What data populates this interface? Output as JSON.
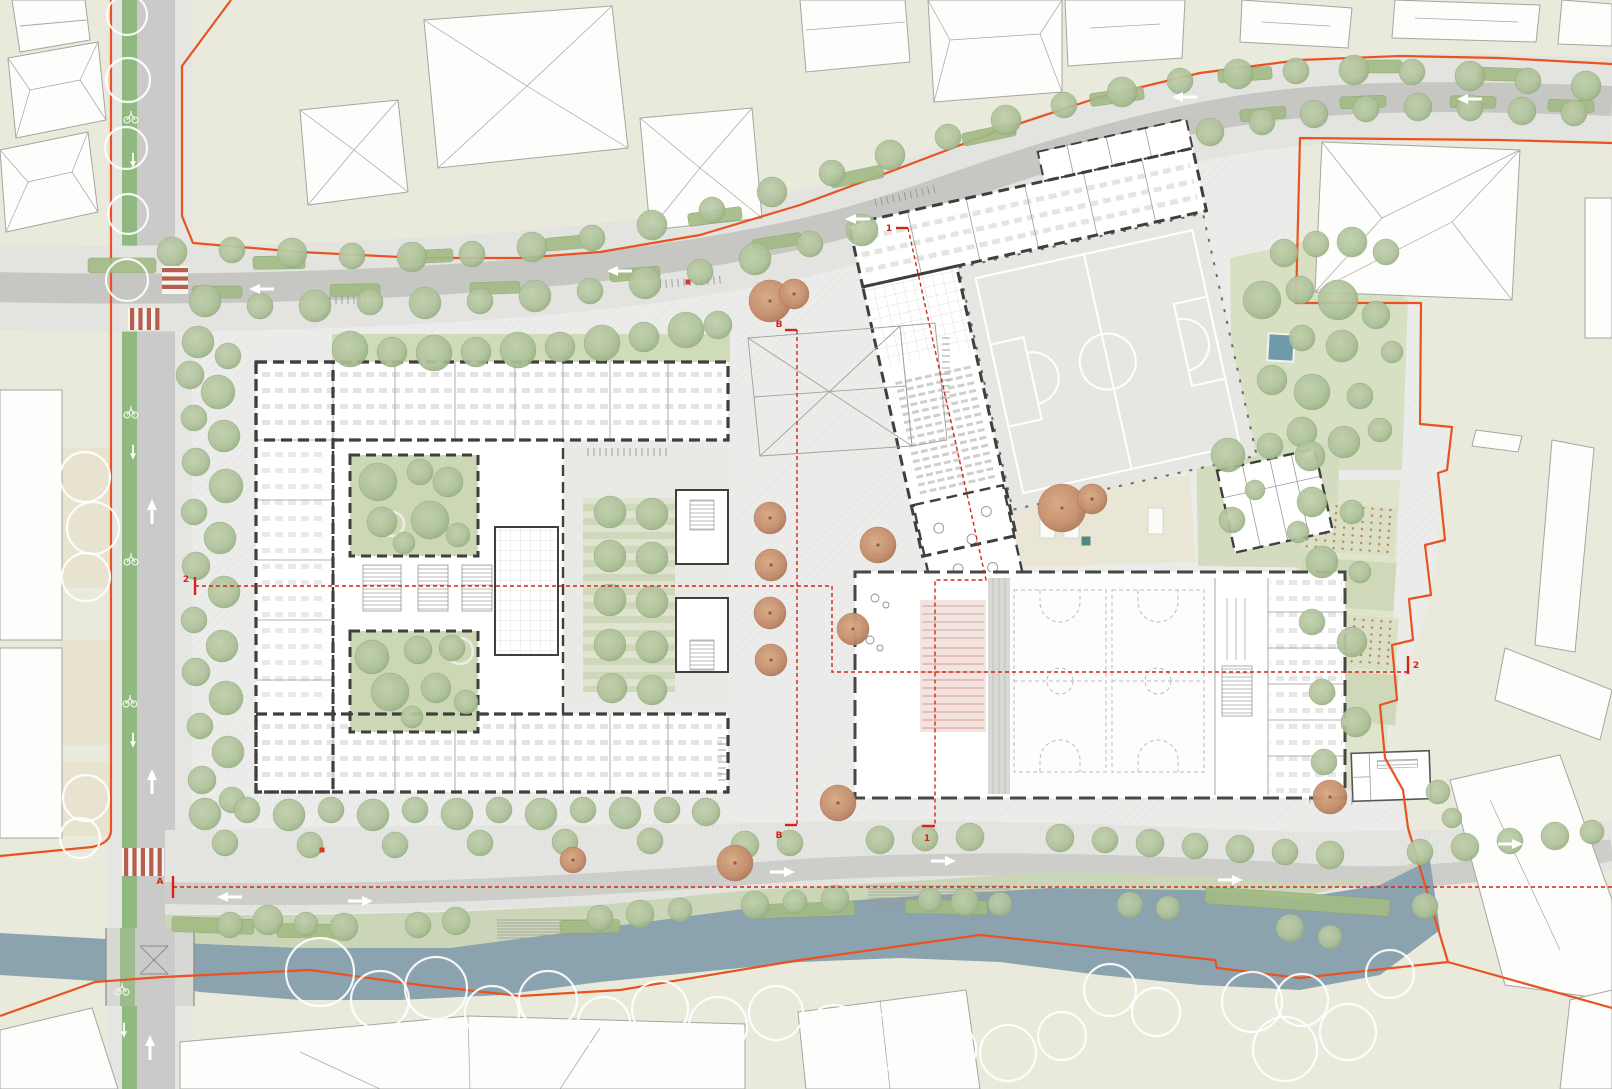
{
  "meta": {
    "drawing_type": "architectural site / ground-floor master plan",
    "content": "school campus with two courtyards, rooftop soccer pitch building, double sports hall, plaza, tree-lined streets and canal"
  },
  "colors": {
    "ground_context": "#e9eadb",
    "site_paving": "#ecedea",
    "lawn": "#cfdbb9",
    "lawn_bright": "#d8e0c4",
    "hedge": "#a3bb85",
    "tree_green": "#aec29b",
    "tree_orange": "#c68f6d",
    "water": "#8ba3ae",
    "road": "#cacac8",
    "sidewalk": "#e5e5e1",
    "bike_lane": "#8fb97e",
    "crosswalk_red": "#b5604e",
    "boundary_orange": "#e8531f",
    "section_red": "#d42518",
    "wall_dark": "#3f3f3e",
    "pitch": "#e6e6e2",
    "tribune_red": "#cf9c92",
    "pool_blue": "#6f9aaa"
  },
  "sections": [
    {
      "id": "A",
      "path": "M173 887 L1612 887",
      "ticks": [
        "M173 876 L173 898"
      ],
      "labels": [
        {
          "t": "A",
          "x": 160,
          "y": 884
        }
      ]
    },
    {
      "id": "B",
      "path": "M797 330 L797 825",
      "ticks": [
        "M785 330 L797 330",
        "M785 825 L797 825"
      ],
      "labels": [
        {
          "t": "B",
          "x": 779,
          "y": 327
        },
        {
          "t": "B",
          "x": 779,
          "y": 838
        }
      ]
    },
    {
      "id": "1",
      "path": "M908 228 L986 580 L935 580 L935 826",
      "ticks": [
        "M896 228 L908 228",
        "M922 826 L935 826"
      ],
      "labels": [
        {
          "t": "1",
          "x": 889,
          "y": 231
        },
        {
          "t": "1",
          "x": 927,
          "y": 841
        }
      ]
    },
    {
      "id": "2",
      "path": "M195 586 L832 586 L832 672 L1408 672",
      "ticks": [
        "M195 577 L195 595",
        "M1408 656 L1408 674"
      ],
      "labels": [
        {
          "t": "2",
          "x": 186,
          "y": 582
        },
        {
          "t": "2",
          "x": 1416,
          "y": 668
        }
      ]
    }
  ],
  "trees": {
    "green": [
      [
        172,
        252,
        15
      ],
      [
        232,
        250,
        13
      ],
      [
        292,
        253,
        15
      ],
      [
        352,
        256,
        13
      ],
      [
        412,
        257,
        15
      ],
      [
        472,
        254,
        13
      ],
      [
        532,
        247,
        15
      ],
      [
        592,
        238,
        13
      ],
      [
        652,
        225,
        15
      ],
      [
        712,
        210,
        13
      ],
      [
        772,
        192,
        15
      ],
      [
        832,
        173,
        13
      ],
      [
        890,
        155,
        15
      ],
      [
        948,
        137,
        13
      ],
      [
        1006,
        120,
        15
      ],
      [
        1064,
        105,
        13
      ],
      [
        1122,
        92,
        15
      ],
      [
        1180,
        81,
        13
      ],
      [
        1238,
        74,
        15
      ],
      [
        1296,
        71,
        13
      ],
      [
        1354,
        70,
        15
      ],
      [
        1412,
        72,
        13
      ],
      [
        1470,
        76,
        15
      ],
      [
        1528,
        81,
        13
      ],
      [
        1586,
        86,
        15
      ],
      [
        205,
        301,
        16
      ],
      [
        260,
        306,
        13
      ],
      [
        315,
        306,
        16
      ],
      [
        370,
        302,
        13
      ],
      [
        425,
        303,
        16
      ],
      [
        480,
        301,
        13
      ],
      [
        535,
        296,
        16
      ],
      [
        590,
        291,
        13
      ],
      [
        645,
        283,
        16
      ],
      [
        700,
        272,
        13
      ],
      [
        755,
        259,
        16
      ],
      [
        810,
        244,
        13
      ],
      [
        862,
        230,
        16
      ],
      [
        1210,
        132,
        14
      ],
      [
        1262,
        122,
        13
      ],
      [
        1314,
        114,
        14
      ],
      [
        1366,
        109,
        13
      ],
      [
        1418,
        107,
        14
      ],
      [
        1470,
        108,
        13
      ],
      [
        1522,
        111,
        14
      ],
      [
        1574,
        113,
        13
      ],
      [
        350,
        349,
        18
      ],
      [
        392,
        352,
        15
      ],
      [
        434,
        353,
        18
      ],
      [
        476,
        352,
        15
      ],
      [
        518,
        350,
        18
      ],
      [
        560,
        347,
        15
      ],
      [
        602,
        343,
        18
      ],
      [
        644,
        337,
        15
      ],
      [
        686,
        330,
        18
      ],
      [
        718,
        325,
        14
      ],
      [
        198,
        342,
        16
      ],
      [
        228,
        356,
        13
      ],
      [
        190,
        375,
        14
      ],
      [
        218,
        392,
        17
      ],
      [
        194,
        418,
        13
      ],
      [
        224,
        436,
        16
      ],
      [
        196,
        462,
        14
      ],
      [
        226,
        486,
        17
      ],
      [
        194,
        512,
        13
      ],
      [
        220,
        538,
        16
      ],
      [
        196,
        566,
        14
      ],
      [
        224,
        592,
        16
      ],
      [
        194,
        620,
        13
      ],
      [
        222,
        646,
        16
      ],
      [
        196,
        672,
        14
      ],
      [
        226,
        698,
        17
      ],
      [
        200,
        726,
        13
      ],
      [
        228,
        752,
        16
      ],
      [
        202,
        780,
        14
      ],
      [
        232,
        800,
        13
      ],
      [
        205,
        814,
        16
      ],
      [
        247,
        810,
        13
      ],
      [
        289,
        815,
        16
      ],
      [
        331,
        810,
        13
      ],
      [
        373,
        815,
        16
      ],
      [
        415,
        810,
        13
      ],
      [
        457,
        814,
        16
      ],
      [
        499,
        810,
        13
      ],
      [
        541,
        814,
        16
      ],
      [
        583,
        810,
        13
      ],
      [
        625,
        813,
        16
      ],
      [
        667,
        810,
        13
      ],
      [
        706,
        812,
        14
      ],
      [
        225,
        843,
        13
      ],
      [
        310,
        845,
        13
      ],
      [
        395,
        845,
        13
      ],
      [
        480,
        843,
        13
      ],
      [
        565,
        842,
        13
      ],
      [
        650,
        841,
        13
      ],
      [
        745,
        845,
        14
      ],
      [
        790,
        843,
        13
      ],
      [
        880,
        840,
        14
      ],
      [
        925,
        838,
        13
      ],
      [
        970,
        837,
        14
      ],
      [
        1060,
        838,
        14
      ],
      [
        1105,
        840,
        13
      ],
      [
        1150,
        843,
        14
      ],
      [
        1195,
        846,
        13
      ],
      [
        1240,
        849,
        14
      ],
      [
        1285,
        852,
        13
      ],
      [
        1330,
        855,
        14
      ],
      [
        1420,
        852,
        13
      ],
      [
        1465,
        847,
        14
      ],
      [
        1510,
        841,
        13
      ],
      [
        1555,
        836,
        14
      ],
      [
        1592,
        832,
        12
      ],
      [
        230,
        925,
        13
      ],
      [
        268,
        920,
        15
      ],
      [
        306,
        924,
        12
      ],
      [
        344,
        927,
        14
      ],
      [
        418,
        925,
        13
      ],
      [
        456,
        921,
        14
      ],
      [
        600,
        918,
        13
      ],
      [
        640,
        914,
        14
      ],
      [
        680,
        910,
        12
      ],
      [
        755,
        905,
        14
      ],
      [
        795,
        902,
        12
      ],
      [
        835,
        899,
        14
      ],
      [
        930,
        900,
        12
      ],
      [
        965,
        902,
        14
      ],
      [
        1000,
        904,
        12
      ],
      [
        1130,
        905,
        13
      ],
      [
        1168,
        908,
        12
      ],
      [
        1290,
        928,
        14
      ],
      [
        1330,
        937,
        12
      ],
      [
        1425,
        906,
        13
      ],
      [
        610,
        512,
        16
      ],
      [
        652,
        514,
        16
      ],
      [
        610,
        556,
        16
      ],
      [
        652,
        558,
        16
      ],
      [
        610,
        600,
        16
      ],
      [
        652,
        602,
        16
      ],
      [
        610,
        645,
        16
      ],
      [
        652,
        647,
        16
      ],
      [
        612,
        688,
        15
      ],
      [
        652,
        690,
        15
      ],
      [
        378,
        482,
        19
      ],
      [
        420,
        472,
        13
      ],
      [
        448,
        482,
        15
      ],
      [
        382,
        522,
        15
      ],
      [
        430,
        520,
        19
      ],
      [
        458,
        535,
        12
      ],
      [
        404,
        543,
        11
      ],
      [
        372,
        657,
        17
      ],
      [
        418,
        650,
        14
      ],
      [
        452,
        648,
        13
      ],
      [
        390,
        692,
        19
      ],
      [
        436,
        688,
        15
      ],
      [
        466,
        702,
        12
      ],
      [
        412,
        717,
        11
      ],
      [
        1262,
        300,
        19
      ],
      [
        1300,
        290,
        14
      ],
      [
        1338,
        300,
        20
      ],
      [
        1376,
        315,
        14
      ],
      [
        1302,
        338,
        13
      ],
      [
        1342,
        346,
        16
      ],
      [
        1272,
        380,
        15
      ],
      [
        1312,
        392,
        18
      ],
      [
        1360,
        396,
        13
      ],
      [
        1302,
        432,
        15
      ],
      [
        1344,
        442,
        16
      ],
      [
        1380,
        430,
        12
      ],
      [
        1392,
        352,
        11
      ],
      [
        1386,
        252,
        13
      ],
      [
        1352,
        242,
        15
      ],
      [
        1316,
        244,
        13
      ],
      [
        1284,
        253,
        14
      ],
      [
        1312,
        502,
        15
      ],
      [
        1352,
        512,
        12
      ],
      [
        1322,
        562,
        16
      ],
      [
        1360,
        572,
        11
      ],
      [
        1312,
        622,
        13
      ],
      [
        1352,
        642,
        15
      ],
      [
        1322,
        692,
        13
      ],
      [
        1356,
        722,
        15
      ],
      [
        1324,
        762,
        13
      ],
      [
        1228,
        455,
        17
      ],
      [
        1270,
        446,
        13
      ],
      [
        1310,
        456,
        15
      ],
      [
        1232,
        520,
        13
      ],
      [
        1298,
        532,
        11
      ],
      [
        1255,
        490,
        10
      ],
      [
        1438,
        792,
        12
      ],
      [
        1452,
        818,
        10
      ]
    ],
    "orange": [
      [
        770,
        301,
        21
      ],
      [
        794,
        294,
        15
      ],
      [
        770,
        518,
        16
      ],
      [
        771,
        565,
        16
      ],
      [
        770,
        613,
        16
      ],
      [
        771,
        660,
        16
      ],
      [
        878,
        545,
        18
      ],
      [
        853,
        629,
        16
      ],
      [
        838,
        803,
        18
      ],
      [
        735,
        863,
        18
      ],
      [
        573,
        860,
        13
      ],
      [
        1062,
        508,
        24
      ],
      [
        1092,
        499,
        15
      ],
      [
        1330,
        797,
        17
      ]
    ],
    "outline": [
      [
        127,
        15,
        20
      ],
      [
        128,
        80,
        22
      ],
      [
        126,
        148,
        21
      ],
      [
        128,
        214,
        20
      ],
      [
        127,
        280,
        21
      ],
      [
        85,
        477,
        25
      ],
      [
        93,
        528,
        26
      ],
      [
        86,
        577,
        24
      ],
      [
        86,
        798,
        23
      ],
      [
        80,
        838,
        20
      ],
      [
        320,
        972,
        34
      ],
      [
        380,
        1000,
        29
      ],
      [
        436,
        988,
        31
      ],
      [
        492,
        1013,
        27
      ],
      [
        548,
        1000,
        29
      ],
      [
        604,
        1023,
        26
      ],
      [
        660,
        1009,
        28
      ],
      [
        718,
        1026,
        29
      ],
      [
        776,
        1013,
        27
      ],
      [
        834,
        1031,
        26
      ],
      [
        892,
        1041,
        28
      ],
      [
        950,
        1049,
        26
      ],
      [
        1008,
        1053,
        28
      ],
      [
        1062,
        1036,
        24
      ],
      [
        1110,
        990,
        26
      ],
      [
        1156,
        1012,
        24
      ],
      [
        1252,
        1002,
        30
      ],
      [
        1285,
        1049,
        32
      ],
      [
        1302,
        1000,
        26
      ],
      [
        1348,
        1032,
        28
      ],
      [
        1390,
        974,
        24
      ]
    ]
  },
  "hedges": [
    [
      88,
      258,
      68,
      15,
      0
    ],
    [
      253,
      256,
      52,
      13,
      -1
    ],
    [
      399,
      250,
      54,
      13,
      -3
    ],
    [
      545,
      236,
      54,
      13,
      -5
    ],
    [
      688,
      210,
      54,
      13,
      -8
    ],
    [
      830,
      170,
      54,
      13,
      -12
    ],
    [
      962,
      128,
      54,
      13,
      -12
    ],
    [
      1090,
      90,
      54,
      13,
      -8
    ],
    [
      1218,
      68,
      54,
      13,
      -4
    ],
    [
      1348,
      60,
      54,
      13,
      0
    ],
    [
      1478,
      68,
      54,
      13,
      2
    ],
    [
      192,
      286,
      50,
      12,
      0
    ],
    [
      330,
      284,
      50,
      12,
      -1
    ],
    [
      470,
      282,
      50,
      12,
      -2
    ],
    [
      610,
      268,
      50,
      12,
      -5
    ],
    [
      752,
      236,
      50,
      12,
      -9
    ],
    [
      1240,
      108,
      46,
      12,
      -5
    ],
    [
      1340,
      96,
      46,
      12,
      -2
    ],
    [
      1450,
      96,
      46,
      12,
      1
    ],
    [
      1548,
      100,
      46,
      12,
      2
    ],
    [
      172,
      918,
      82,
      15,
      2
    ],
    [
      277,
      924,
      72,
      14,
      1
    ],
    [
      560,
      920,
      60,
      13,
      -1
    ],
    [
      755,
      903,
      100,
      14,
      -2
    ],
    [
      905,
      900,
      82,
      14,
      1
    ],
    [
      1205,
      893,
      185,
      17,
      4
    ]
  ],
  "benches": [
    [
      770,
      301
    ],
    [
      770,
      518
    ],
    [
      771,
      565
    ],
    [
      770,
      613
    ],
    [
      771,
      660
    ],
    [
      878,
      545
    ],
    [
      853,
      629
    ],
    [
      838,
      803
    ],
    [
      735,
      863
    ],
    [
      1330,
      797
    ]
  ],
  "arrows": {
    "up": [
      [
        152,
        512
      ],
      [
        152,
        782
      ],
      [
        150,
        1048
      ]
    ],
    "down_small": [
      [
        133,
        160
      ],
      [
        133,
        452
      ],
      [
        133,
        740
      ],
      [
        124,
        1030
      ]
    ],
    "left": [
      [
        262,
        289
      ],
      [
        620,
        271
      ],
      [
        858,
        219
      ],
      [
        1185,
        97
      ],
      [
        1470,
        99
      ],
      [
        230,
        897
      ]
    ],
    "right": [
      [
        360,
        901
      ],
      [
        782,
        872
      ],
      [
        943,
        861
      ],
      [
        1230,
        880
      ],
      [
        1510,
        844
      ]
    ]
  },
  "bikes": [
    [
      131,
      118
    ],
    [
      131,
      413
    ],
    [
      131,
      560
    ],
    [
      130,
      702
    ],
    [
      122,
      990
    ]
  ],
  "bike_racks": [
    [
      318,
      300,
      55,
      -1
    ],
    [
      588,
      452,
      80,
      0
    ],
    [
      660,
      282,
      60,
      -4
    ],
    [
      875,
      196,
      60,
      -13
    ],
    [
      916,
      368,
      60,
      90
    ],
    [
      700,
      760,
      44,
      90
    ],
    [
      1310,
      800,
      45,
      2
    ]
  ],
  "crosswalks": [
    [
      162,
      266,
      26,
      28,
      "h"
    ],
    [
      128,
      308,
      30,
      22,
      "v"
    ],
    [
      122,
      848,
      42,
      28,
      "v"
    ]
  ],
  "mats": [
    [
      1040,
      512,
      15,
      26
    ],
    [
      1064,
      512,
      15,
      26
    ],
    [
      1148,
      508,
      15,
      26
    ]
  ],
  "squares": [
    [
      1086,
      541,
      9,
      "#4e8a80"
    ],
    [
      322,
      850,
      5,
      "#cf3b28"
    ],
    [
      688,
      282,
      5,
      "#cf3b28"
    ]
  ]
}
